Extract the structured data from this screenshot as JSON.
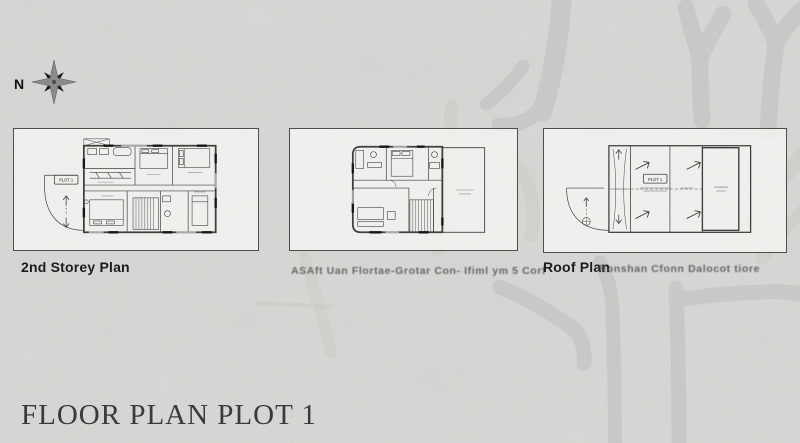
{
  "page": {
    "sheet_title": "FLOOR PLAN PLOT 1"
  },
  "compass": {
    "north_label": "N"
  },
  "panels": {
    "second_storey": {
      "caption": "2nd Storey Plan",
      "plot_label": "PLOT 1"
    },
    "attic": {
      "caption_ghost": "ASAft  Uan Flortae-Grotar Con- Ifiml  ym  5 Corf"
    },
    "roof": {
      "caption": "Roof Plan",
      "caption_ghost": "Ronshan Cfonn Dalocot tiore",
      "plot_label": "PLOT 1"
    }
  },
  "colors": {
    "background": "#dcdbd9",
    "panel_fill": "#f5f4f2",
    "panel_border": "#4d4d4b",
    "plan_ink": "#3f3f3d",
    "watermark": "#c5c4c2",
    "caption_text": "#1c1c1c",
    "title_text": "#3a3a3a"
  }
}
